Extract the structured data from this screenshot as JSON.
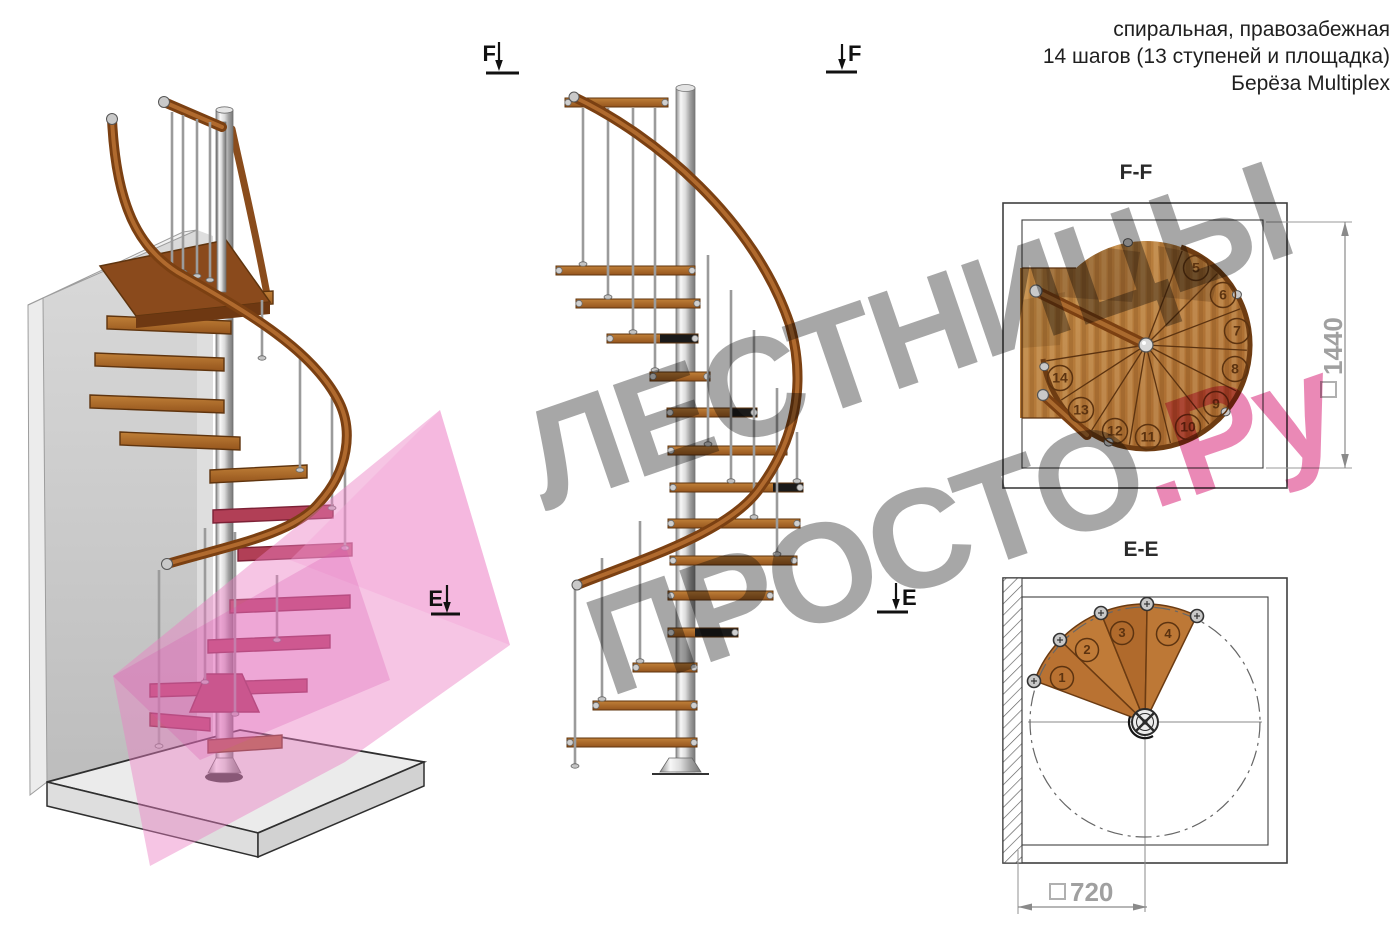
{
  "header": {
    "line1": "спиральная, правозабежная",
    "line2": "14 шагов (13 ступеней и площадка)",
    "line3": "Берёза Multiplex"
  },
  "watermark": {
    "gray1": "ЛЕСТНИЦЫ",
    "gray2": "ПРОСТО",
    "pink": ".Ру"
  },
  "sections": {
    "ff_title": "F-F",
    "ee_title": "E-E",
    "marker_f": "F",
    "marker_e": "E"
  },
  "dimensions": {
    "ff": "1440",
    "ee": "720"
  },
  "colors": {
    "wood_mid": "#a8652a",
    "wood_dark": "#5f340e",
    "maroon_step": "#b13f56",
    "metal": "#c9c9c9",
    "pink_plane": "#ec7fc4",
    "dim_gray": "#a0a0a0",
    "line_dark": "#3f3f3f",
    "text_dark": "#1c1c1c"
  },
  "ff_plan": {
    "center": [
      1146,
      345
    ],
    "radius": 104,
    "sector_angles": [
      -69,
      -45,
      -21,
      3,
      27,
      51.5,
      76,
      99.5,
      122.5,
      147,
      171
    ],
    "rim_dot_angles": [
      -100,
      -29,
      40,
      111,
      168
    ],
    "step_numbers": [
      {
        "n": "5",
        "x": 1196,
        "y": 268
      },
      {
        "n": "6",
        "x": 1223,
        "y": 295
      },
      {
        "n": "7",
        "x": 1237,
        "y": 331
      },
      {
        "n": "8",
        "x": 1235,
        "y": 369
      },
      {
        "n": "9",
        "x": 1216,
        "y": 404
      },
      {
        "n": "10",
        "x": 1188,
        "y": 427
      },
      {
        "n": "11",
        "x": 1148,
        "y": 437
      },
      {
        "n": "12",
        "x": 1115,
        "y": 431
      },
      {
        "n": "13",
        "x": 1081,
        "y": 410
      },
      {
        "n": "14",
        "x": 1060,
        "y": 378
      }
    ]
  },
  "ee_plan": {
    "center": [
      1145,
      722
    ],
    "fan_radius": 118,
    "circle_radius": 115,
    "edge_angles": [
      200.5,
      224,
      248,
      271,
      296
    ],
    "bolts": [
      [
        1034,
        681
      ],
      [
        1060,
        640
      ],
      [
        1101,
        613
      ],
      [
        1147,
        604
      ],
      [
        1197,
        616
      ]
    ],
    "step_numbers": [
      {
        "n": "1",
        "x": 1062,
        "y": 678
      },
      {
        "n": "2",
        "x": 1087,
        "y": 650
      },
      {
        "n": "3",
        "x": 1122,
        "y": 633
      },
      {
        "n": "4",
        "x": 1168,
        "y": 634
      }
    ]
  },
  "elevation": {
    "steps": [
      {
        "x1": 565,
        "x2": 668,
        "y": 98
      },
      {
        "x1": 556,
        "x2": 695,
        "y": 266
      },
      {
        "x1": 576,
        "x2": 700,
        "y": 299
      },
      {
        "x1": 607,
        "x2": 698,
        "y": 334,
        "black": [
          660,
          698
        ]
      },
      {
        "x1": 650,
        "x2": 710,
        "y": 372
      },
      {
        "x1": 667,
        "x2": 757,
        "y": 408,
        "black": [
          732,
          757
        ]
      },
      {
        "x1": 668,
        "x2": 787,
        "y": 446
      },
      {
        "x1": 670,
        "x2": 803,
        "y": 483,
        "black": [
          773,
          803
        ]
      },
      {
        "x1": 668,
        "x2": 800,
        "y": 519
      },
      {
        "x1": 670,
        "x2": 797,
        "y": 556
      },
      {
        "x1": 668,
        "x2": 773,
        "y": 591
      },
      {
        "x1": 668,
        "x2": 738,
        "y": 628,
        "black": [
          695,
          738
        ]
      },
      {
        "x1": 633,
        "x2": 697,
        "y": 663
      },
      {
        "x1": 593,
        "x2": 697,
        "y": 701
      },
      {
        "x1": 567,
        "x2": 697,
        "y": 738
      }
    ],
    "balusters": [
      [
        583,
        108,
        264
      ],
      [
        608,
        108,
        297
      ],
      [
        633,
        108,
        332
      ],
      [
        655,
        108,
        370
      ],
      [
        708,
        255,
        444
      ],
      [
        731,
        290,
        481
      ],
      [
        754,
        330,
        517
      ],
      [
        777,
        388,
        554
      ],
      [
        797,
        432,
        481
      ],
      [
        575,
        588,
        766
      ],
      [
        602,
        558,
        699
      ],
      [
        640,
        521,
        661
      ]
    ]
  },
  "view3d": {
    "steps": [
      {
        "x1": 187,
        "x2": 273,
        "y": 296,
        "c": "w"
      },
      {
        "x1": 107,
        "x2": 231,
        "y": 321,
        "c": "w"
      },
      {
        "x1": 95,
        "x2": 224,
        "y": 358,
        "c": "w"
      },
      {
        "x1": 90,
        "x2": 224,
        "y": 400,
        "c": "w"
      },
      {
        "x1": 120,
        "x2": 240,
        "y": 437,
        "c": "w"
      },
      {
        "x1": 210,
        "x2": 307,
        "y": 470,
        "c": "w"
      },
      {
        "x1": 213,
        "x2": 333,
        "y": 510,
        "c": "m"
      },
      {
        "x1": 238,
        "x2": 352,
        "y": 548,
        "c": "m"
      },
      {
        "x1": 230,
        "x2": 350,
        "y": 600,
        "c": "m"
      },
      {
        "x1": 208,
        "x2": 330,
        "y": 640,
        "c": "m"
      },
      {
        "x1": 150,
        "x2": 307,
        "y": 684,
        "c": "m"
      },
      {
        "x1": 150,
        "x2": 210,
        "y": 718,
        "c": "m"
      },
      {
        "x1": 208,
        "x2": 282,
        "y": 740,
        "c": "w2"
      }
    ],
    "balusters": [
      [
        172,
        112,
        268
      ],
      [
        183,
        115,
        272
      ],
      [
        197,
        119,
        276
      ],
      [
        210,
        122,
        280
      ],
      [
        262,
        300,
        358
      ],
      [
        300,
        352,
        470
      ],
      [
        332,
        398,
        508
      ],
      [
        345,
        452,
        548
      ],
      [
        205,
        528,
        682
      ],
      [
        235,
        532,
        714
      ],
      [
        159,
        570,
        746
      ],
      [
        277,
        575,
        640
      ]
    ]
  }
}
